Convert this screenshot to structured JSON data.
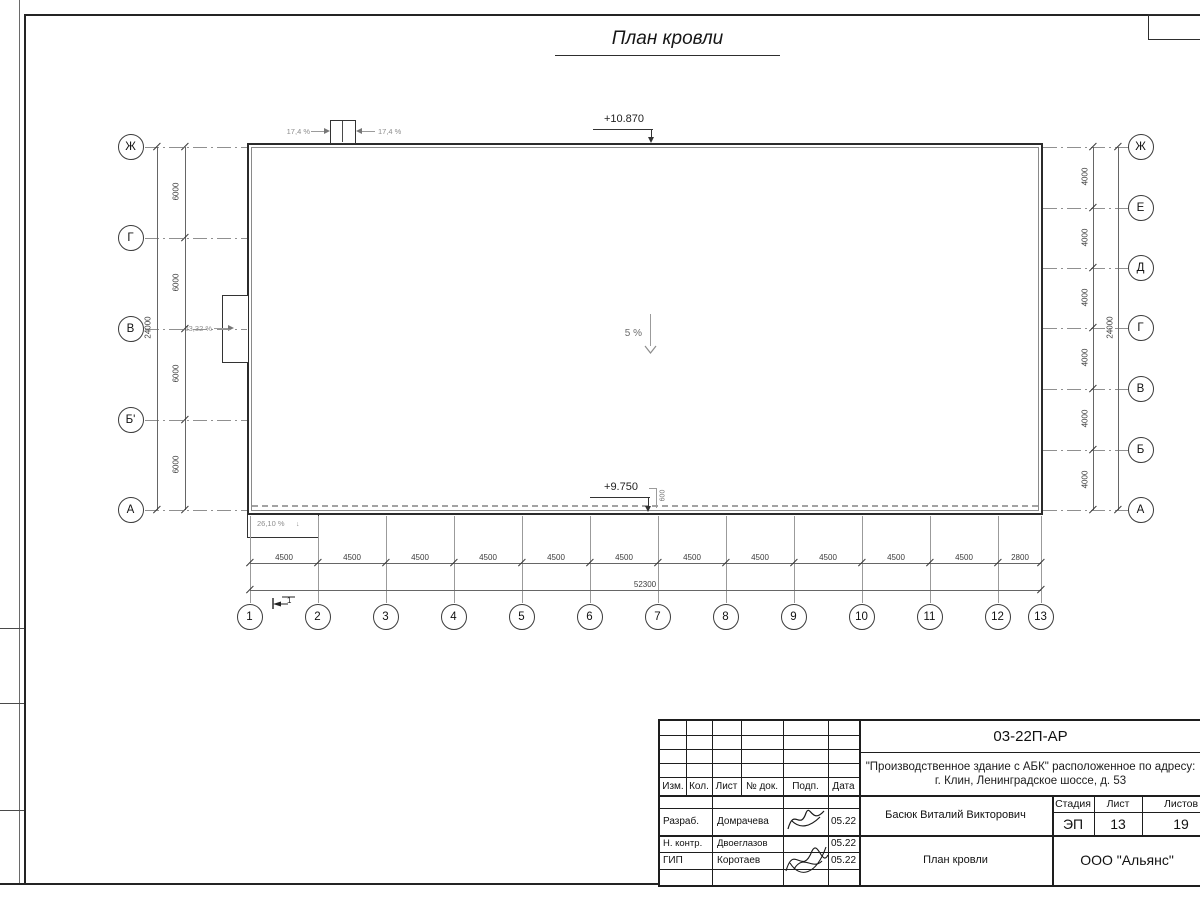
{
  "sheet": {
    "title": "План кровли"
  },
  "plan": {
    "elevation_top": "+10.870",
    "elevation_bottom": "+9.750",
    "slope_center": "5 %",
    "slope_left": "23,32 %",
    "slope_canopy": "26,10 %",
    "slope_canopy_arrow": "↓",
    "skylight_slope_left": "17,4 %",
    "skylight_slope_right": "17,4 %",
    "parapet_dim": "600",
    "section_mark": "1",
    "left_axes": [
      "Ж",
      "Г",
      "В",
      "Б'",
      "А"
    ],
    "left_dims": [
      "6000",
      "6000",
      "6000",
      "6000"
    ],
    "left_total": "24000",
    "right_axes": [
      "Ж",
      "Е",
      "Д",
      "Г",
      "В",
      "Б",
      "А"
    ],
    "right_dims": [
      "4000",
      "4000",
      "4000",
      "4000",
      "4000",
      "4000"
    ],
    "right_total": "24000",
    "columns": [
      "1",
      "2",
      "3",
      "4",
      "5",
      "6",
      "7",
      "8",
      "9",
      "10",
      "11",
      "12",
      "13"
    ],
    "bottom_dims": [
      "4500",
      "4500",
      "4500",
      "4500",
      "4500",
      "4500",
      "4500",
      "4500",
      "4500",
      "4500",
      "4500",
      "2800"
    ],
    "bottom_total": "52300"
  },
  "title_block": {
    "doc_number": "03-22П-АР",
    "project_line1": "\"Производственное здание с АБК\" расположенное по адресу:",
    "project_line2": "г. Клин, Ленинградское шоссе, д. 53",
    "columns": [
      "Изм.",
      "Кол.",
      "Лист",
      "№ док.",
      "Подп.",
      "Дата"
    ],
    "signers": [
      {
        "role": "Разраб.",
        "name": "Домрачева",
        "date": "05.22"
      },
      {
        "role": "Н. контр.",
        "name": "Двоеглазов",
        "date": "05.22"
      },
      {
        "role": "ГИП",
        "name": "Коротаев",
        "date": "05.22"
      }
    ],
    "approver": "Басюк Виталий Викторович",
    "stage_label": "Стадия",
    "sheet_label": "Лист",
    "sheets_label": "Листов",
    "stage": "ЭП",
    "sheet_num": "13",
    "sheets_total": "19",
    "drawing_name": "План кровли",
    "company": "ООО \"Альянс\""
  }
}
